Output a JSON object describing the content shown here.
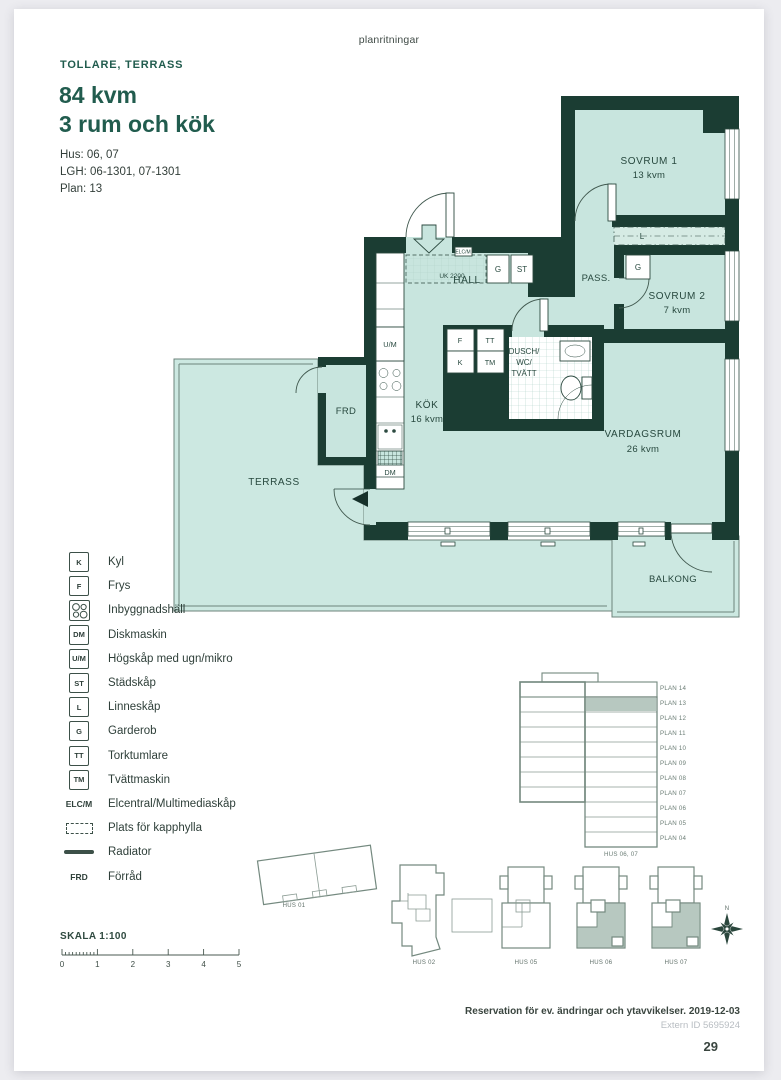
{
  "page": {
    "brand": "planritningar",
    "project": "TOLLARE, TERRASS",
    "title_line1": "84 kvm",
    "title_line2": "3 rum och kök",
    "meta_hus": "Hus: 06, 07",
    "meta_lgh": "LGH: 06-1301, 07-1301",
    "meta_plan": "Plan: 13",
    "footer_note": "Reservation för ev. ändringar och ytavvikelser. 2019-12-03",
    "footer_extern_id": "Extern ID 5695924",
    "page_number": "29"
  },
  "floorplan": {
    "rooms": {
      "sovrum1_name": "SOVRUM 1",
      "sovrum1_area": "13 kvm",
      "sovrum2_name": "SOVRUM 2",
      "sovrum2_area": "7 kvm",
      "pass": "PASS.",
      "hall": "HALL",
      "kok_name": "KÖK",
      "kok_area": "16 kvm",
      "vardagsrum_name": "VARDAGSRUM",
      "vardagsrum_area": "26 kvm",
      "bad_line1": "DUSCH/",
      "bad_line2": "WC/",
      "bad_line3": "TVÄTT",
      "frd": "FRD",
      "terrass": "TERRASS",
      "balkong": "BALKONG"
    },
    "markers": {
      "g_hall": "G",
      "st": "ST",
      "l": "L",
      "g_sovrum2": "G",
      "f": "F",
      "k": "K",
      "tt": "TT",
      "tm": "TM",
      "um": "U/M",
      "dm": "DM",
      "elcm": "ELC/M",
      "uk2200": "UK 2200"
    }
  },
  "legend": {
    "items": [
      {
        "abbr": "K",
        "label": "Kyl",
        "icon": "box"
      },
      {
        "abbr": "F",
        "label": "Frys",
        "icon": "box"
      },
      {
        "abbr": "",
        "label": "Inbyggnadshäll",
        "icon": "hob"
      },
      {
        "abbr": "DM",
        "label": "Diskmaskin",
        "icon": "box"
      },
      {
        "abbr": "U/M",
        "label": "Högskåp med ugn/mikro",
        "icon": "box"
      },
      {
        "abbr": "ST",
        "label": "Städskåp",
        "icon": "box"
      },
      {
        "abbr": "L",
        "label": "Linneskåp",
        "icon": "box"
      },
      {
        "abbr": "G",
        "label": "Garderob",
        "icon": "box"
      },
      {
        "abbr": "TT",
        "label": "Torktumlare",
        "icon": "box"
      },
      {
        "abbr": "TM",
        "label": "Tvättmaskin",
        "icon": "box"
      },
      {
        "abbr": "ELC/M",
        "label": "Elcentral/Multimediaskåp",
        "icon": "text"
      },
      {
        "abbr": "",
        "label": "Plats för kapphylla",
        "icon": "dashed"
      },
      {
        "abbr": "",
        "label": "Radiator",
        "icon": "line"
      },
      {
        "abbr": "FRD",
        "label": "Förråd",
        "icon": "text"
      }
    ]
  },
  "elevation": {
    "floors": [
      "PLAN 14",
      "PLAN 13",
      "PLAN 12",
      "PLAN 11",
      "PLAN 10",
      "PLAN 09",
      "PLAN 08",
      "PLAN 07",
      "PLAN 06",
      "PLAN 05",
      "PLAN 04"
    ],
    "building": "HUS 06, 07"
  },
  "siteplan": {
    "hus01": "HUS 01",
    "hus02": "HUS 02",
    "hus05": "HUS 05",
    "hus06": "HUS 06",
    "hus07": "HUS 07",
    "compass": "N"
  },
  "scalebar": {
    "label": "SKALA 1:100",
    "ticks": [
      "0",
      "1",
      "2",
      "3",
      "4",
      "5"
    ]
  },
  "colors": {
    "wall": "#1b3d33",
    "room_fill": "#c8e5de",
    "outdoor_fill": "#cce8e1",
    "heading": "#215c4e",
    "outline_gray": "#74897f",
    "highlight": "#b7c8c0"
  }
}
